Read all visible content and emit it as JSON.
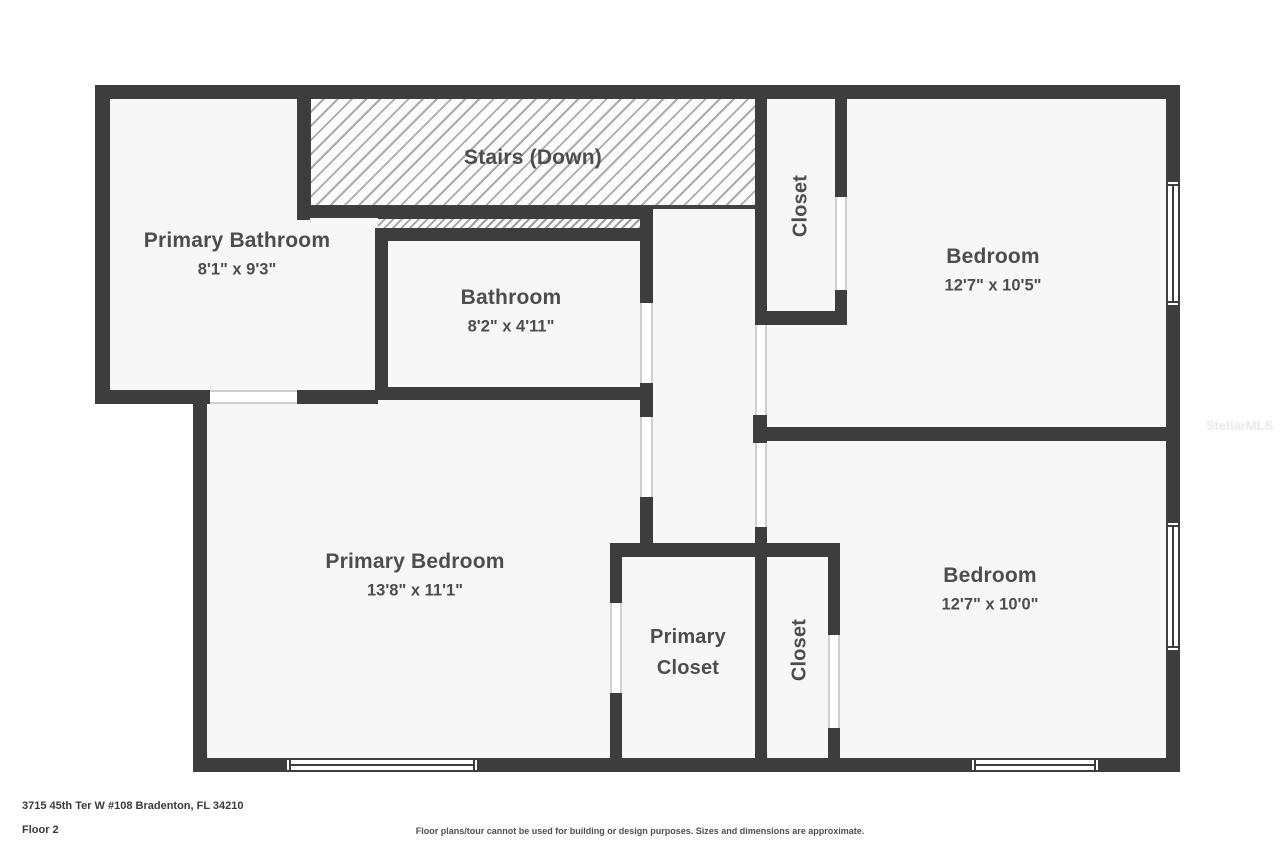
{
  "colors": {
    "wall": "#3d3d3d",
    "room_fill": "#f7f7f7",
    "label_text": "#4d4d4d"
  },
  "rooms": {
    "stairs": {
      "name": "Stairs (Down)"
    },
    "primary_bathroom": {
      "name": "Primary Bathroom",
      "dims": "8'1\" x 9'3\""
    },
    "bathroom": {
      "name": "Bathroom",
      "dims": "8'2\" x 4'11\""
    },
    "closet_top": {
      "name": "Closet"
    },
    "bedroom_top_right": {
      "name": "Bedroom",
      "dims": "12'7\" x 10'5\""
    },
    "primary_bedroom": {
      "name": "Primary Bedroom",
      "dims": "13'8\" x 11'1\""
    },
    "primary_closet": {
      "name": "Primary Closet"
    },
    "closet_bottom": {
      "name": "Closet"
    },
    "bedroom_bottom_right": {
      "name": "Bedroom",
      "dims": "12'7\" x 10'0\""
    }
  },
  "footer": {
    "address": "3715 45th Ter W #108 Bradenton, FL 34210",
    "floor": "Floor 2",
    "disclaimer": "Floor plans/tour cannot be used for building or design purposes. Sizes and dimensions are approximate."
  },
  "watermark": "StellarMLS"
}
